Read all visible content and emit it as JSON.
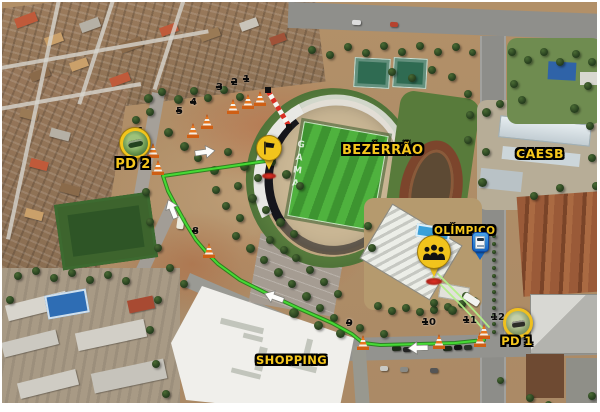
{
  "labels": {
    "estadio_line1": "ESTÁDIO",
    "estadio_line2": "BEZERRÃO",
    "centro_line1": "CENTRO",
    "centro_line2": "OLÍMPICO",
    "caesb": "CAESB",
    "gama_line1": "GAMA",
    "gama_line2": "SHOPPING",
    "pd1": "PD 1",
    "pd2": "PD 2",
    "grass_text": "GAMA"
  },
  "icons": {
    "pd2_pin": "speed-camera-photo-pin",
    "pd1_pin": "speed-camera-photo-ring-pin",
    "start_pin": "flag-icon",
    "centro_pin": "people-group-icon",
    "bus_stop_pin": "bus-icon",
    "cone": "traffic-cone-icon",
    "direction_arrow": "white-arrow-icon",
    "barrier": "red-white-barrier"
  },
  "markers": {
    "cones": [
      {
        "n": "1",
        "x": 260,
        "y": 106,
        "side": "l"
      },
      {
        "n": "2",
        "x": 248,
        "y": 109,
        "side": "l"
      },
      {
        "n": "3",
        "x": 233,
        "y": 114,
        "side": "l"
      },
      {
        "n": "4",
        "x": 207,
        "y": 129,
        "side": "l"
      },
      {
        "n": "5",
        "x": 193,
        "y": 138,
        "side": "l"
      },
      {
        "n": "6",
        "x": 153,
        "y": 158,
        "side": "l"
      },
      {
        "n": "7",
        "x": 158,
        "y": 175,
        "side": "l"
      },
      {
        "n": "8",
        "x": 209,
        "y": 258,
        "side": "l"
      },
      {
        "n": "9",
        "x": 363,
        "y": 350,
        "side": "l"
      },
      {
        "n": "10",
        "x": 439,
        "y": 349,
        "side": "l"
      },
      {
        "n": "11",
        "x": 480,
        "y": 347,
        "side": "l"
      },
      {
        "n": "12",
        "x": 484,
        "y": 339,
        "side": "r"
      }
    ],
    "pins": [
      {
        "id": "pd2",
        "x": 133,
        "y": 141,
        "label": "PD 2"
      },
      {
        "id": "start-flag",
        "x": 267,
        "y": 146
      },
      {
        "id": "centro-olimpico",
        "x": 432,
        "y": 250
      },
      {
        "id": "pd1",
        "x": 516,
        "y": 321,
        "label": "PD 1"
      },
      {
        "id": "bus-stop",
        "x": 478,
        "y": 241
      }
    ]
  },
  "routes": {
    "main": {
      "color_bright": "#46da35",
      "color_dark": "#1c7d13",
      "points": [
        [
          266,
          161
        ],
        [
          232,
          166
        ],
        [
          163,
          176
        ],
        [
          168,
          191
        ],
        [
          176,
          206
        ],
        [
          186,
          224
        ],
        [
          196,
          240
        ],
        [
          208,
          254
        ],
        [
          218,
          264
        ],
        [
          240,
          280
        ],
        [
          268,
          294
        ],
        [
          300,
          309
        ],
        [
          332,
          323
        ],
        [
          352,
          334
        ],
        [
          363,
          343
        ],
        [
          380,
          345
        ],
        [
          420,
          344
        ],
        [
          455,
          343
        ],
        [
          484,
          340
        ]
      ]
    },
    "secondary": {
      "color": "#b2ef86",
      "lines": [
        [
          [
            433,
            277
          ],
          [
            447,
            291
          ],
          [
            462,
            306
          ],
          [
            476,
            321
          ],
          [
            485,
            331
          ]
        ],
        [
          [
            438,
            274
          ],
          [
            452,
            288
          ],
          [
            467,
            303
          ],
          [
            480,
            317
          ],
          [
            489,
            327
          ]
        ]
      ]
    }
  },
  "barrier": {
    "x1": 268,
    "y1": 91,
    "x2": 289,
    "y2": 126,
    "red": "#d92f23"
  },
  "arrows": [
    {
      "x": 205,
      "y": 152,
      "deg": -8
    },
    {
      "x": 172,
      "y": 209,
      "deg": -112
    },
    {
      "x": 274,
      "y": 297,
      "deg": 200
    },
    {
      "x": 418,
      "y": 348,
      "deg": 178
    }
  ],
  "colors": {
    "label_yellow": "#f6c71d",
    "route_green": "#46da35",
    "cone_orange": "#e8761e",
    "pin_yellow": "#f2c41c",
    "bus_pin_blue": "#1565c0"
  }
}
